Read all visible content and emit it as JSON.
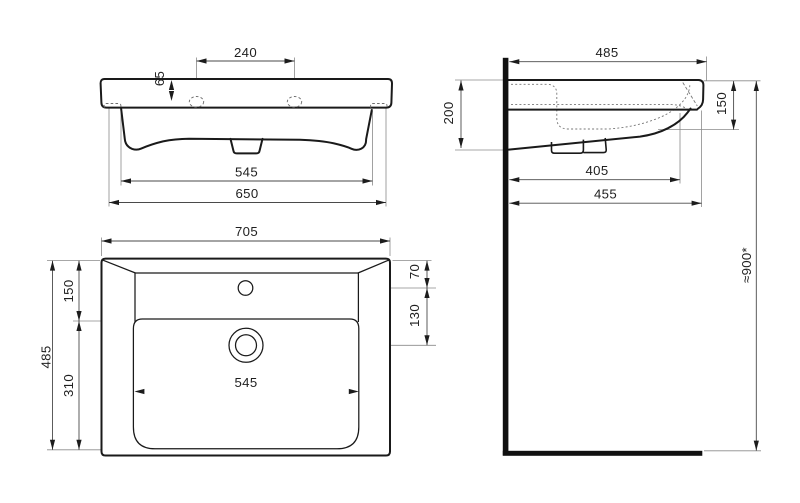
{
  "drawing": {
    "background": "#ffffff",
    "outline_color": "#1a1a1a",
    "dim_line_color": "#4a4a4a",
    "thin_line_color": "#8a8a8a",
    "text_color": "#1f1f1f"
  },
  "views": {
    "front": {
      "hole_spacing": "240",
      "hole_offset": "65",
      "base_width": "545",
      "body_width": "650"
    },
    "plan": {
      "overall_width": "705",
      "overall_depth": "485",
      "edge_to_bowl": "150",
      "bowl_depth": "310",
      "bowl_width": "545",
      "tap_offset": "70",
      "tap_to_drain": "130"
    },
    "side": {
      "overall_depth": "485",
      "wall_height": "200",
      "front_edge_height": "150",
      "underside_depth": "405",
      "lower_depth": "455",
      "install_height": "≈900*"
    }
  }
}
